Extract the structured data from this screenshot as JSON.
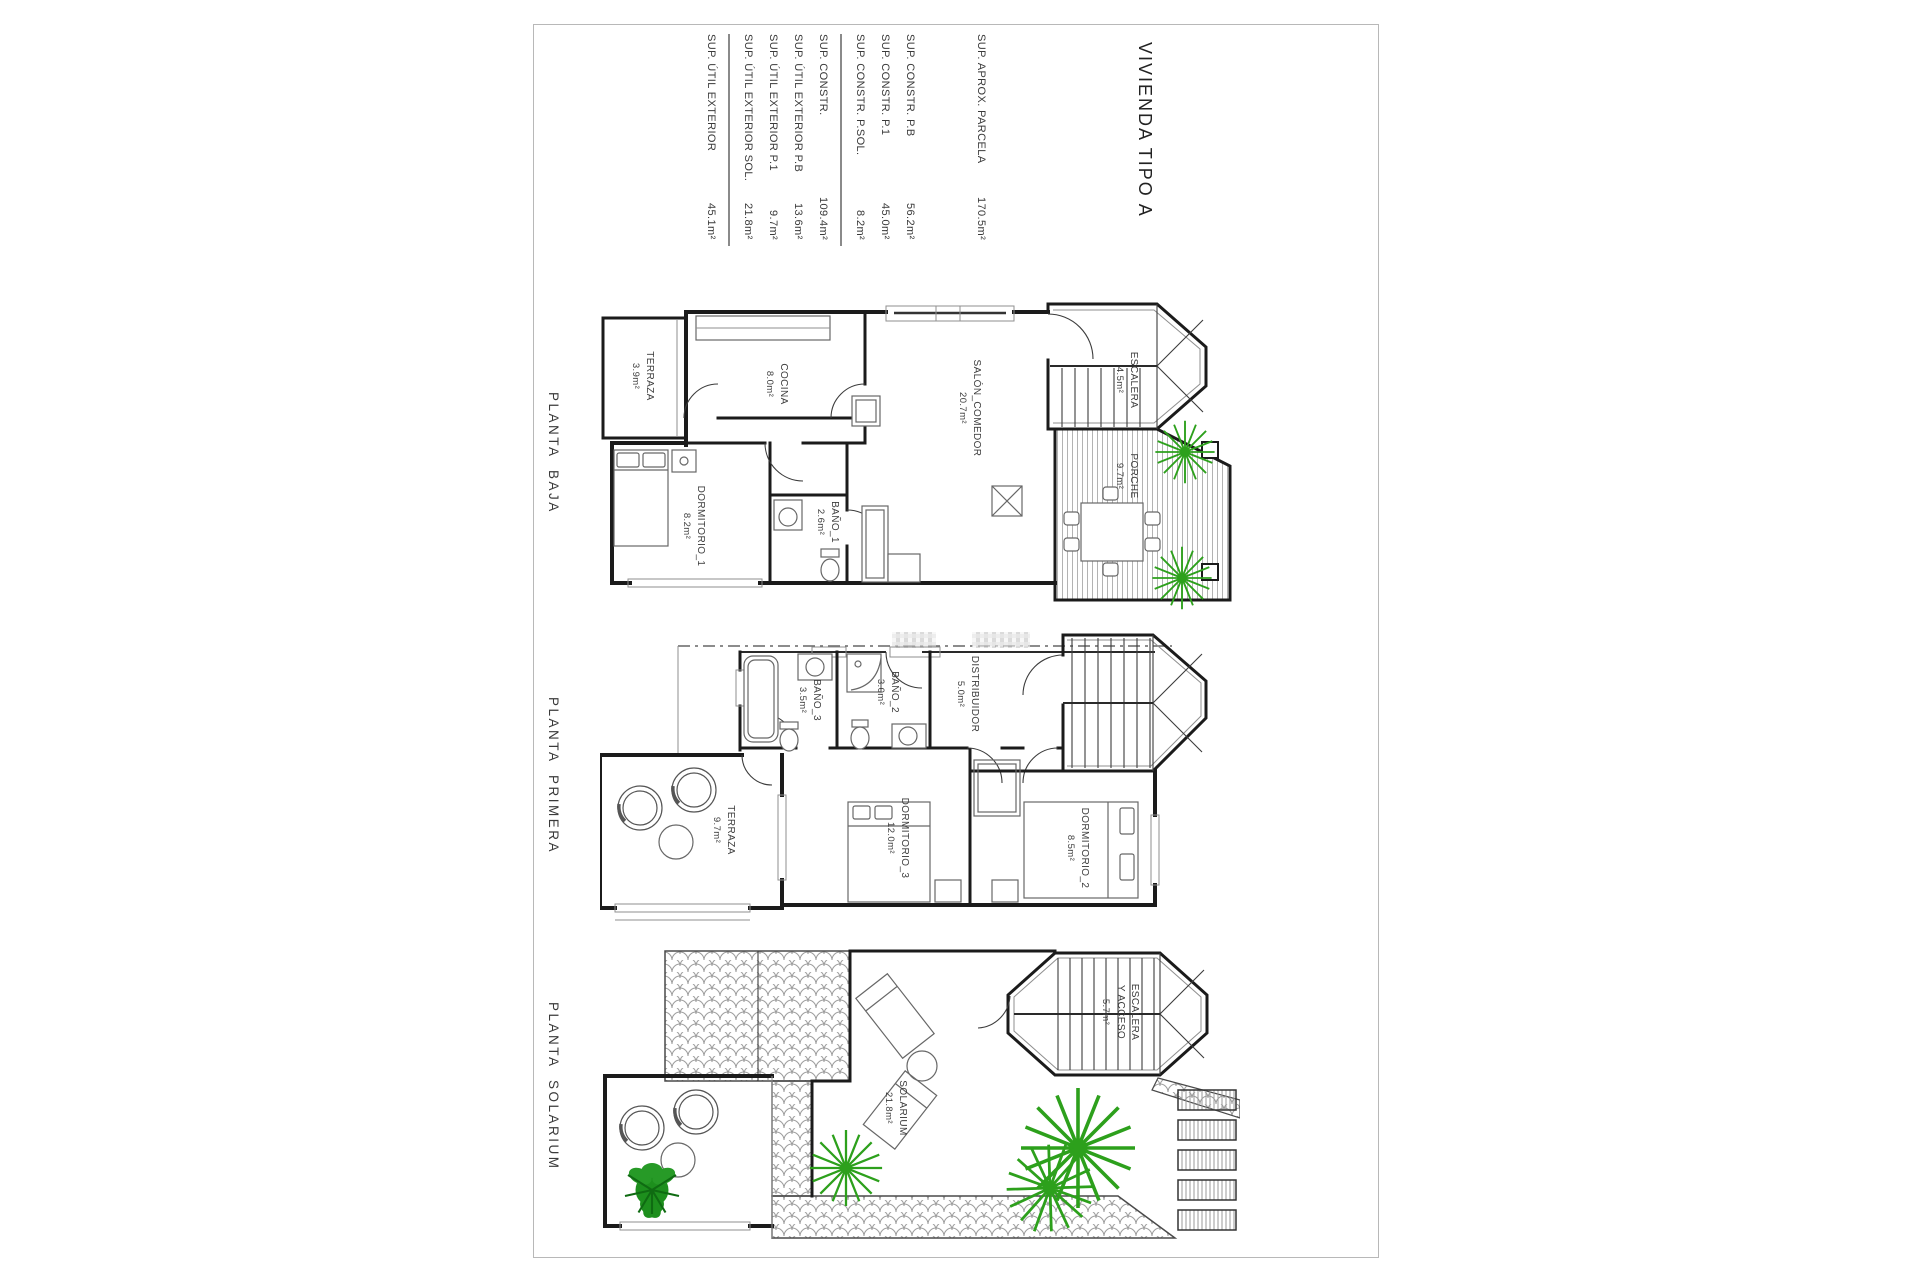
{
  "page": {
    "title": "VIVIENDA TIPO A",
    "areas_table": {
      "rows": [
        {
          "label": "SUP. APROX. PARCELA",
          "value": "170.5m²"
        },
        {
          "label": "SUP. CONSTR.  P.B",
          "value": "56.2m²"
        },
        {
          "label": "SUP. CONSTR.  P.1",
          "value": "45.0m²"
        },
        {
          "label": "SUP. CONSTR.  P.SOL.",
          "value": "8.2m²"
        },
        {
          "label": "SUP. CONSTR.",
          "value": "109.4m²",
          "total": true
        },
        {
          "label": "SUP. ÚTIL EXTERIOR  P.B",
          "value": "13.6m²"
        },
        {
          "label": "SUP. ÚTIL EXTERIOR  P.1",
          "value": "9.7m²"
        },
        {
          "label": "SUP. ÚTIL EXTERIOR  SOL.",
          "value": "21.8m²"
        },
        {
          "label": "SUP. ÚTIL EXTERIOR",
          "value": "45.1m²",
          "total": true
        }
      ]
    },
    "plans": [
      {
        "name": "PLANTA BAJA",
        "rooms": [
          {
            "name": "TERRAZA",
            "area": "3.9m²"
          },
          {
            "name": "COCINA",
            "area": "8.0m²"
          },
          {
            "name": "SALÓN_COMEDOR",
            "area": "20.7m²"
          },
          {
            "name": "DORMITORIO_1",
            "area": "8.2m²"
          },
          {
            "name": "BAÑO_1",
            "area": "2.6m²"
          },
          {
            "name": "ESCALERA",
            "area": "4.5m²"
          },
          {
            "name": "PORCHE",
            "area": "9.7m²"
          }
        ]
      },
      {
        "name": "PLANTA PRIMERA",
        "rooms": [
          {
            "name": "BAÑO_3",
            "area": "3.5m²"
          },
          {
            "name": "BAÑO_2",
            "area": "3.0m²"
          },
          {
            "name": "DISTRIBUIDOR",
            "area": "5.0m²"
          },
          {
            "name": "TERRAZA",
            "area": "9.7m²"
          },
          {
            "name": "DORMITORIO_3",
            "area": "12.0m²"
          },
          {
            "name": "DORMITORIO_2",
            "area": "8.5m²"
          }
        ]
      },
      {
        "name": "PLANTA SOLARIUM",
        "rooms": [
          {
            "name": "ESCALERA Y ACCESO",
            "name_lines": [
              "ESCALERA",
              "Y ACCESO"
            ],
            "area": "5.7m²"
          },
          {
            "name": "SOLARIUM",
            "area": "21.8m²"
          }
        ]
      }
    ],
    "colors": {
      "wall": "#1b1b1b",
      "plant_green": "#2da01c",
      "bush_green": "#1d8f1d",
      "sheet_border": "#b8b8b8",
      "hatch_gray": "#b3b3b3"
    }
  }
}
